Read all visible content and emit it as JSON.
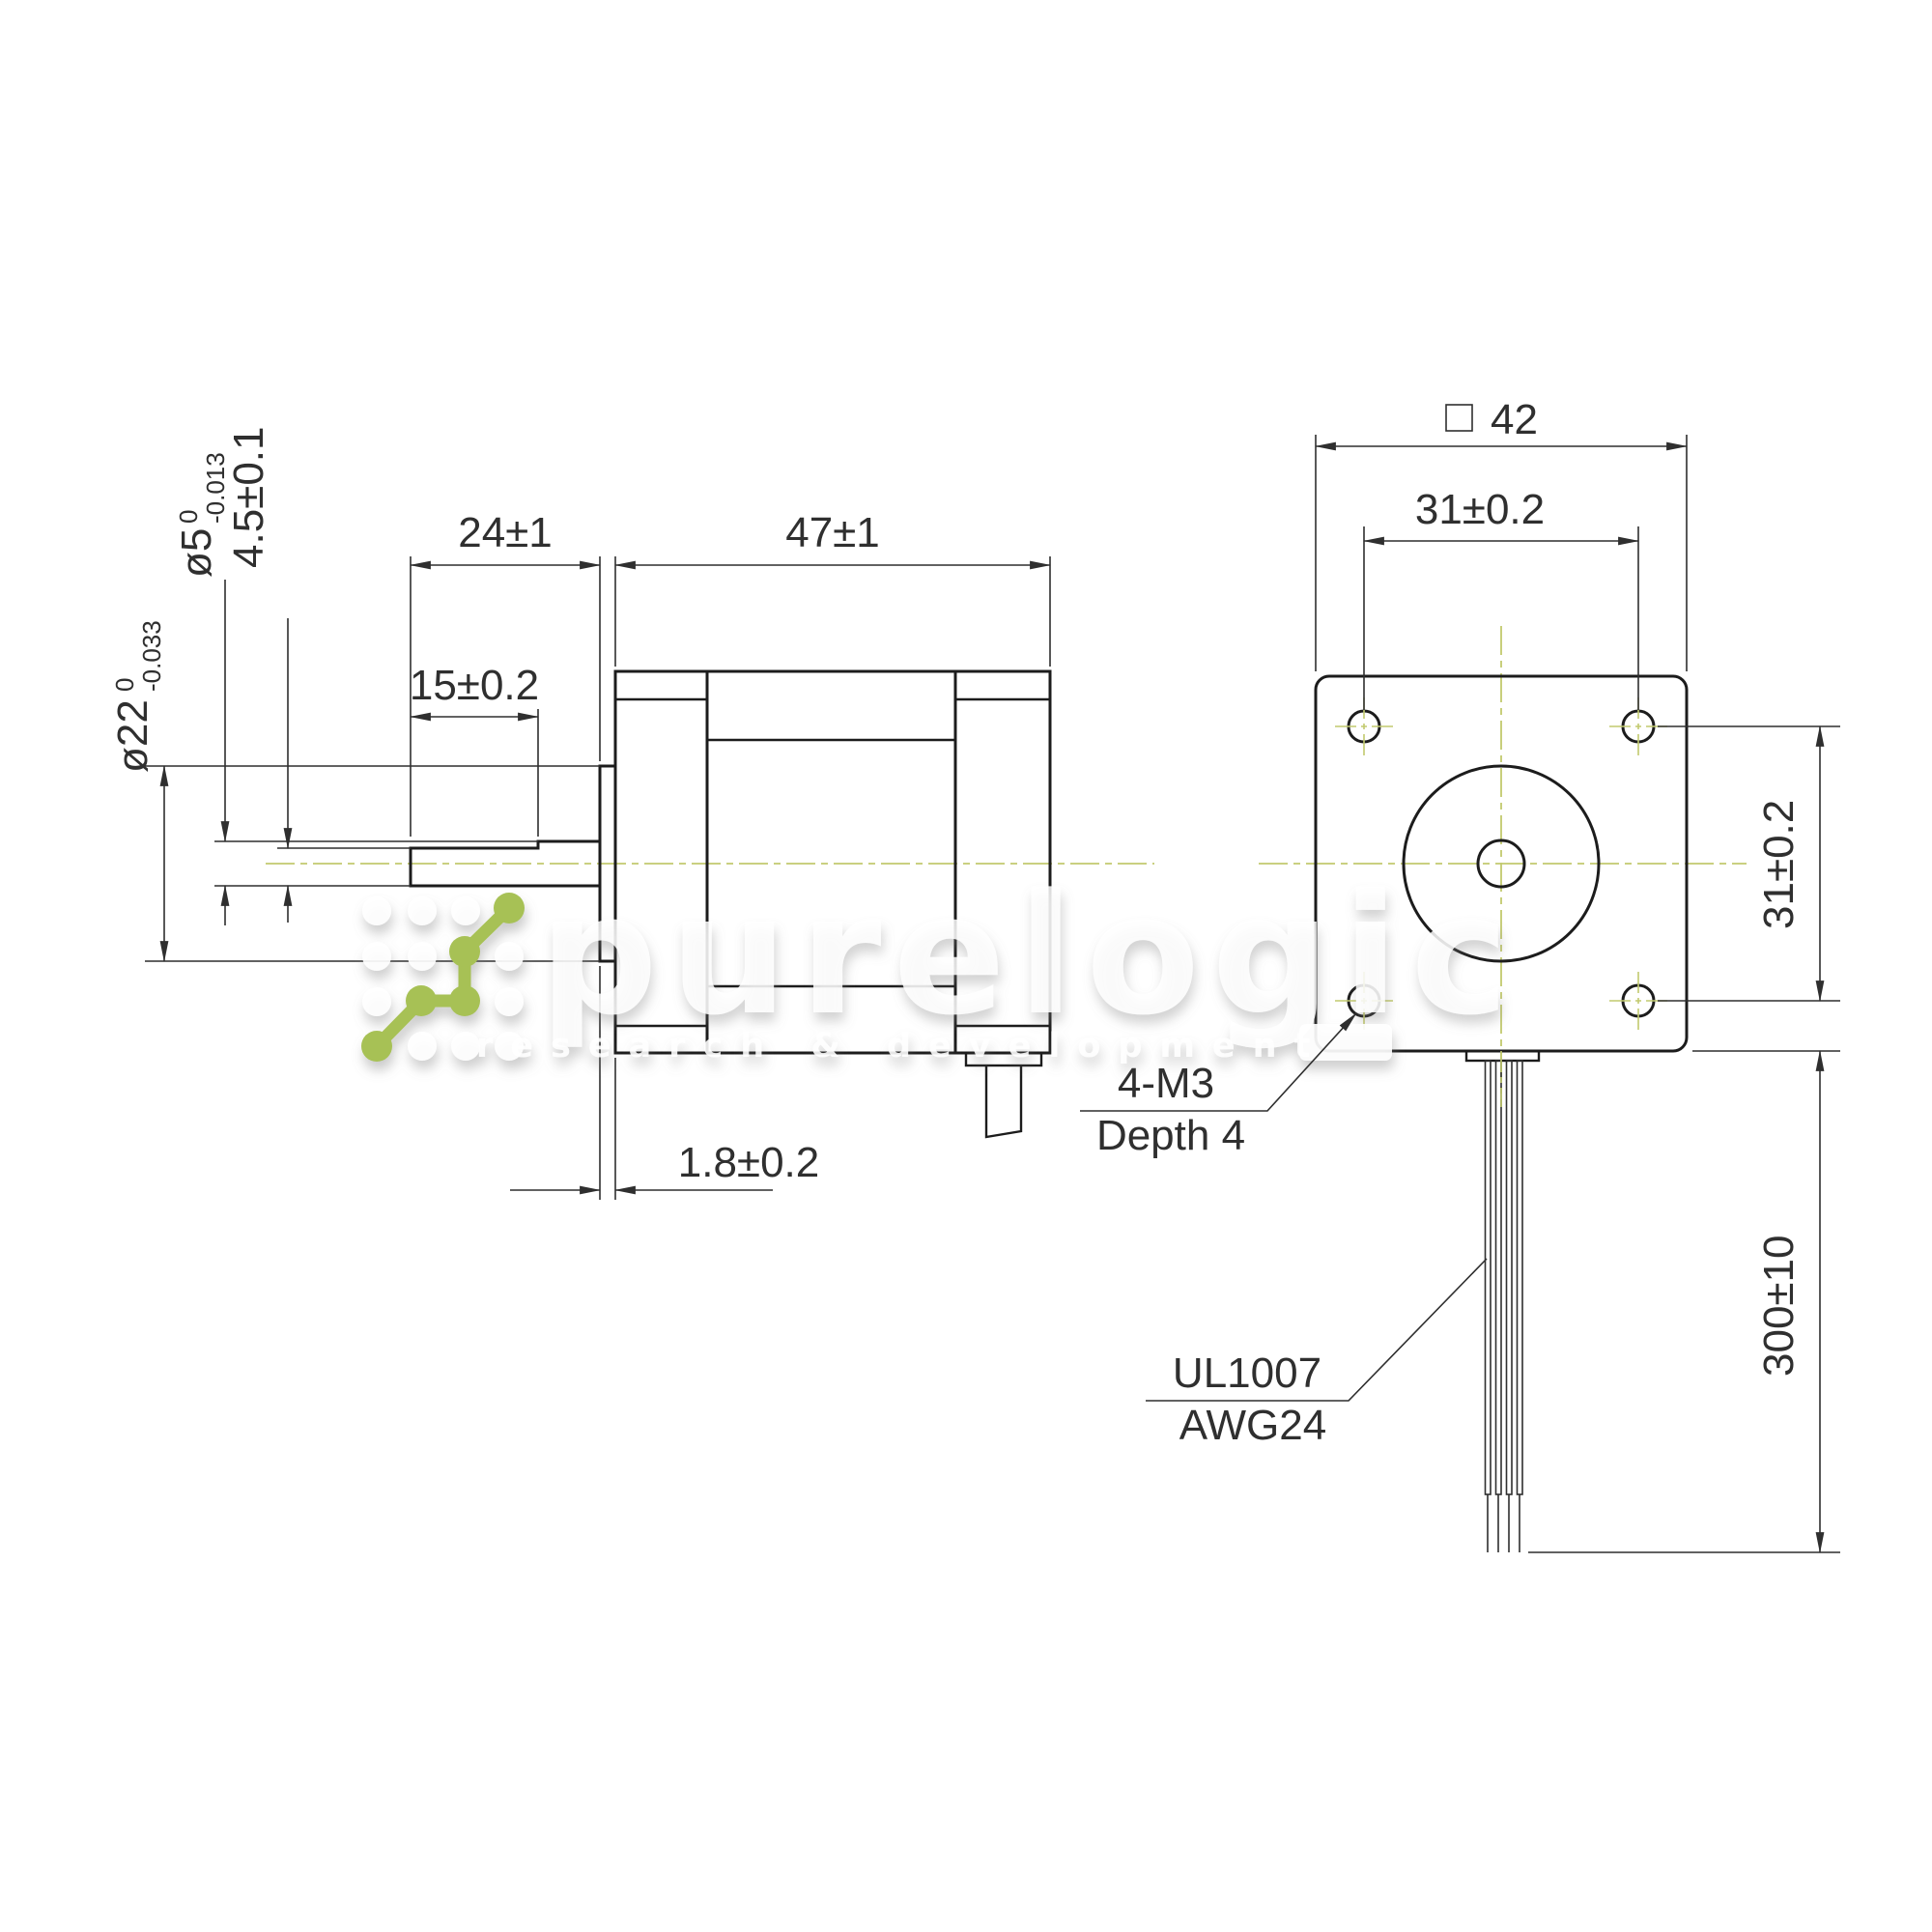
{
  "drawing_title": "stepper motor dimensional drawing",
  "side_view": {
    "dim_shaft_extension": "24±1",
    "dim_body_length": "47±1",
    "dim_flat_length": "15±0.2",
    "dim_boss_height": "1.8±0.2",
    "dim_flat_depth": "4.5±0.1",
    "shaft_diameter": {
      "main": "ø5",
      "sup": "0",
      "sub": "-0.013"
    },
    "boss_diameter": {
      "main": "ø22",
      "sup": "0",
      "sub": "-0.033"
    }
  },
  "front_view": {
    "dim_face_width": "42",
    "dim_hole_spacing_h": "31±0.2",
    "dim_hole_spacing_v": "31±0.2",
    "dim_wire_length": "300±10",
    "mounting_holes_label": {
      "line1": "4-M3",
      "line2": "Depth 4"
    },
    "wire_label": {
      "line1": "UL1007",
      "line2": "AWG24"
    }
  },
  "watermark": {
    "brand": "purelogic",
    "subtitle": "research & development"
  },
  "colors": {
    "line": "#1c1c1c",
    "dim": "#2f2f2f",
    "centerline": "#c2ca6e",
    "logo_green": "#a7c155",
    "watermark_white": "#ffffff",
    "background": "#ffffff"
  }
}
